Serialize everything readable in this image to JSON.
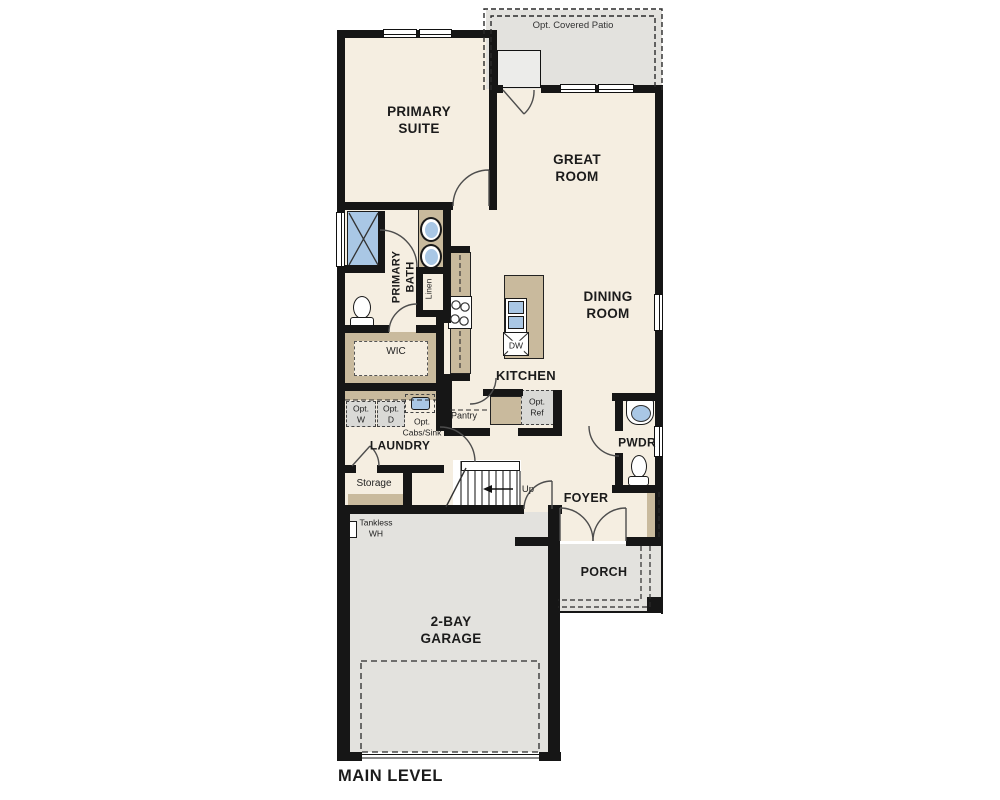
{
  "title": "MAIN LEVEL",
  "colors": {
    "floor": "#f5eee1",
    "hardscape": "#e3e2de",
    "cabinet": "#c9ba9d",
    "fixture_blue": "#a9c7e5",
    "wall": "#161616"
  },
  "labels": {
    "patio": "Opt. Covered Patio",
    "primary_suite": "PRIMARY\nSUITE",
    "great_room": "GREAT\nROOM",
    "dining_room": "DINING\nROOM",
    "primary_bath": "PRIMARY\nBATH",
    "linen": "Linen",
    "wic": "WIC",
    "kitchen": "KITCHEN",
    "pantry": "Pantry",
    "dw": "DW",
    "opt_ref": "Opt.\nRef",
    "opt_w": "Opt.\nW",
    "opt_d": "Opt.\nD",
    "opt_cabs_sink": "Opt.\nCabs/Sink",
    "laundry": "LAUNDRY",
    "storage": "Storage",
    "up": "Up",
    "tankless_wh": "Tankless\nWH",
    "foyer": "FOYER",
    "pwdr": "PWDR",
    "porch": "PORCH",
    "garage": "2-BAY\nGARAGE",
    "main_level": "MAIN LEVEL"
  }
}
